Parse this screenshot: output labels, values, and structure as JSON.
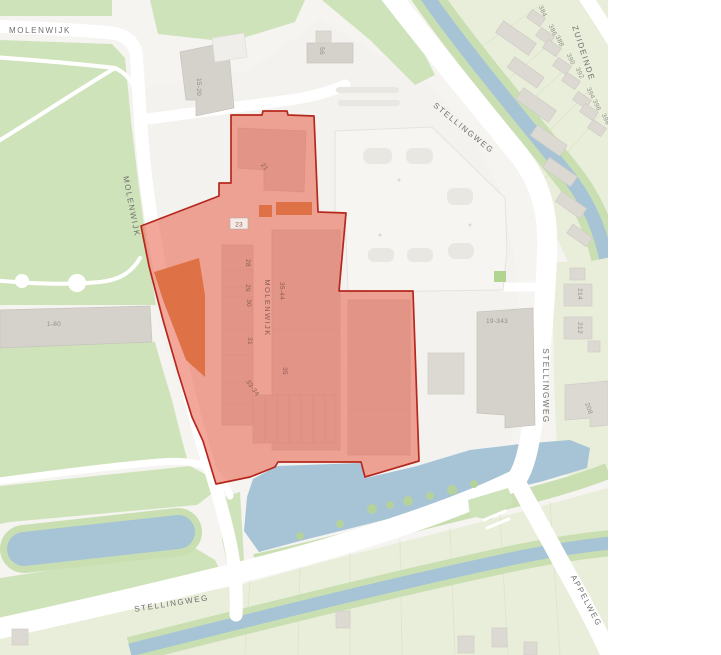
{
  "map": {
    "description": "Street map with red highlighted parcel over Molenwijk shopping block",
    "theme": {
      "water": "#a6c4d6",
      "park_green": "#cfe3ba",
      "field_green": "#e9eeda",
      "bank_green": "#c9dfb2",
      "building_gray": "#dcd9d3",
      "building_dark_gray": "#d5d2cb",
      "orange_building": "#d3904f",
      "overlay_fill": "#e85740",
      "overlay_fill_opacity": 0.52,
      "overlay_stroke": "#b6281e",
      "road_label_color": "#6f6f6f",
      "number_label_color": "#8f8e8a",
      "overlay_label_color": "#8a5c52"
    },
    "road_labels": [
      {
        "name": "road-label-molenwijk-top",
        "text": "MOLENWIJK",
        "x": 40,
        "y": 33,
        "rot": 0
      },
      {
        "name": "road-label-molenwijk-diagonal",
        "text": "MOLENWIJK",
        "x": 129,
        "y": 207,
        "rot": 79
      },
      {
        "name": "road-label-stellingweg-top",
        "text": "STELLINGWEG",
        "x": 462,
        "y": 130,
        "rot": 39
      },
      {
        "name": "road-label-stellingweg-right",
        "text": "STELLINGWEG",
        "x": 543,
        "y": 386,
        "rot": 90
      },
      {
        "name": "road-label-stellingweg-bottom",
        "text": "STELLINGWEG",
        "x": 172,
        "y": 606,
        "rot": -9
      },
      {
        "name": "road-label-zuideinde",
        "text": "ZUIDEINDE",
        "x": 581,
        "y": 54,
        "rot": 72
      },
      {
        "name": "road-label-appelweg",
        "text": "APPELWEG",
        "x": 584,
        "y": 602,
        "rot": 62
      }
    ],
    "number_labels": [
      {
        "name": "building-label-15-20",
        "text": "15-20",
        "x": 197,
        "y": 87,
        "rot": 90
      },
      {
        "name": "building-label-56",
        "text": "56",
        "x": 320,
        "y": 51,
        "rot": 90
      },
      {
        "name": "building-label-1-80",
        "text": "1-80",
        "x": 54,
        "y": 326,
        "rot": 0
      },
      {
        "name": "building-label-19-343",
        "text": "19-343",
        "x": 497,
        "y": 323,
        "rot": 0
      },
      {
        "name": "building-label-214",
        "text": "214",
        "x": 578,
        "y": 294,
        "rot": 90
      },
      {
        "name": "building-label-212",
        "text": "212",
        "x": 578,
        "y": 328,
        "rot": 90
      },
      {
        "name": "building-label-208",
        "text": "208",
        "x": 587,
        "y": 409,
        "rot": 72
      },
      {
        "name": "building-label-384",
        "text": "384",
        "x": 541,
        "y": 12,
        "rot": 65
      },
      {
        "name": "building-label-386",
        "text": "386",
        "x": 551,
        "y": 31,
        "rot": 65
      },
      {
        "name": "building-label-388",
        "text": "388",
        "x": 558,
        "y": 42,
        "rot": 65
      },
      {
        "name": "building-label-390",
        "text": "390",
        "x": 569,
        "y": 60,
        "rot": 65
      },
      {
        "name": "building-label-392",
        "text": "392",
        "x": 578,
        "y": 74,
        "rot": 65
      },
      {
        "name": "building-label-394",
        "text": "394",
        "x": 589,
        "y": 94,
        "rot": 65
      },
      {
        "name": "building-label-396",
        "text": "396",
        "x": 595,
        "y": 106,
        "rot": 65
      },
      {
        "name": "building-label-398",
        "text": "398",
        "x": 604,
        "y": 120,
        "rot": 65
      }
    ],
    "overlay": {
      "polygon_points": "231,115 262,115 263,111 287,111 288,115 314,116 318,212 346,213 339,291 413,291 419,461 365,477 361,462 278,462 275,467 250,477 216,484 203,441 192,417 178,372 163,320 149,266 141,226 219,196 219,183 231,183",
      "boxed_label": {
        "name": "parcel-label-23",
        "text": "23",
        "x": 239,
        "y": 224
      },
      "labels": [
        {
          "name": "parcel-label-21",
          "text": "21",
          "x": 263,
          "y": 168,
          "rot": 50
        },
        {
          "name": "parcel-label-28",
          "text": "28",
          "x": 246,
          "y": 263,
          "rot": 90
        },
        {
          "name": "parcel-label-29",
          "text": "29",
          "x": 246,
          "y": 288,
          "rot": 90
        },
        {
          "name": "parcel-label-30",
          "text": "30",
          "x": 247,
          "y": 303,
          "rot": 90
        },
        {
          "name": "parcel-label-31",
          "text": "31",
          "x": 248,
          "y": 341,
          "rot": 90
        },
        {
          "name": "parcel-label-molenwijk-inner",
          "text": "MOLENWIJK",
          "x": 265,
          "y": 308,
          "rot": 90,
          "cls": "overlay-road"
        },
        {
          "name": "parcel-label-35-44",
          "text": "35-44",
          "x": 280,
          "y": 291,
          "rot": 90
        },
        {
          "name": "parcel-label-35",
          "text": "35",
          "x": 283,
          "y": 371,
          "rot": 90
        },
        {
          "name": "parcel-label-33-34",
          "text": "33-34",
          "x": 251,
          "y": 389,
          "rot": 55
        }
      ]
    }
  }
}
